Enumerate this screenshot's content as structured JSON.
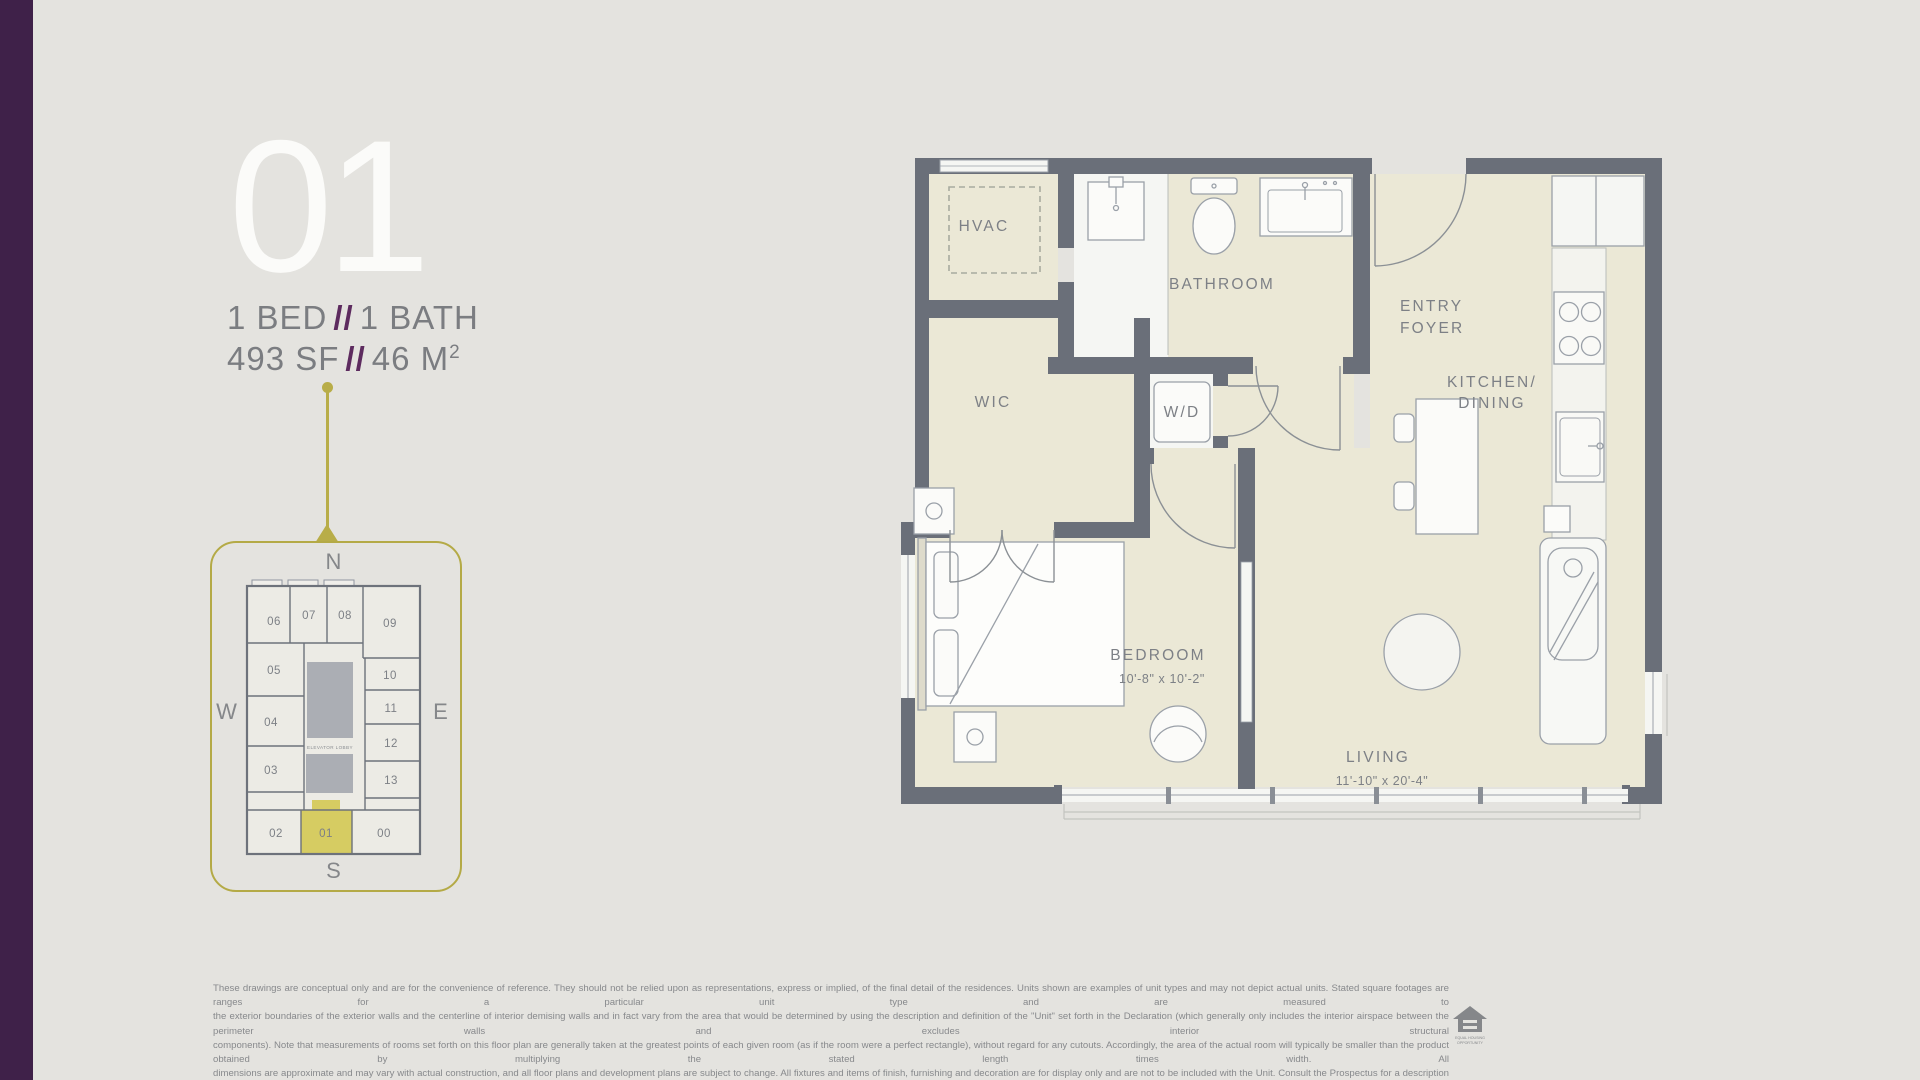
{
  "palette": {
    "background": "#e4e3df",
    "brand_bar": "#3f2149",
    "accent_purple": "#5d2b5f",
    "accent_olive": "#b8ad48",
    "unit_highlight": "#d6cc62",
    "wall": "#6a6f79",
    "floor_cream": "#ebe8d6",
    "text_gray": "#7b7d81"
  },
  "unit": {
    "number": "01",
    "bed": "1 BED",
    "sep": "//",
    "bath": "1 BATH",
    "area_sf": "493 SF",
    "area_m": "46 M",
    "area_m_sup": "2"
  },
  "keyplan": {
    "compass": {
      "n": "N",
      "s": "S",
      "e": "E",
      "w": "W"
    },
    "elevator_label": "ELEVATOR LOBBY",
    "highlight_unit": "01",
    "units": [
      {
        "label": "06"
      },
      {
        "label": "07"
      },
      {
        "label": "08"
      },
      {
        "label": "09"
      },
      {
        "label": "05"
      },
      {
        "label": "10"
      },
      {
        "label": "11"
      },
      {
        "label": "04"
      },
      {
        "label": "12"
      },
      {
        "label": "03"
      },
      {
        "label": "13"
      },
      {
        "label": "02"
      },
      {
        "label": "01"
      },
      {
        "label": "00"
      }
    ]
  },
  "floorplan": {
    "labels": {
      "hvac": "HVAC",
      "bathroom": "BATHROOM",
      "entry_line1": "ENTRY",
      "entry_line2": "FOYER",
      "kitchen_line1": "KITCHEN/",
      "kitchen_line2": "DINING",
      "wd": "W/D",
      "wic": "WIC",
      "bedroom": "BEDROOM",
      "bedroom_dims": "10'-8\" x 10'-2\"",
      "living": "LIVING",
      "living_dims": "11'-10\" x 20'-4\""
    }
  },
  "disclaimer": {
    "line1": "These drawings are conceptual only and are for the convenience of reference. They should not be relied upon as representations, express or implied, of the final detail of the residences. Units shown are examples of unit types and may not depict actual units. Stated square footages are ranges for a particular unit type and are measured to",
    "line2": "the exterior boundaries of the exterior walls and the centerline of interior demising walls and in fact vary from the area that would be determined by using the description and definition of the \"Unit\" set forth in the Declaration (which generally only includes the interior airspace between the perimeter walls and excludes interior structural",
    "line3": "components). Note that measurements of rooms set forth on this floor plan are generally taken at the greatest points of each given room (as if the room were a perfect rectangle), without regard for any cutouts. Accordingly, the area of the actual room will typically be smaller than the product obtained by multiplying the stated length times width. All",
    "line4": "dimensions are approximate and may vary with actual construction, and all floor plans and development plans are subject to change. All fixtures and items of finish, furnishing and decoration are for display only and are not to be included with the Unit. Consult the Prospectus for a description of those features which are to be included in the Unit."
  },
  "logo": {
    "line1": "EQUAL HOUSING",
    "line2": "OPPORTUNITY"
  }
}
